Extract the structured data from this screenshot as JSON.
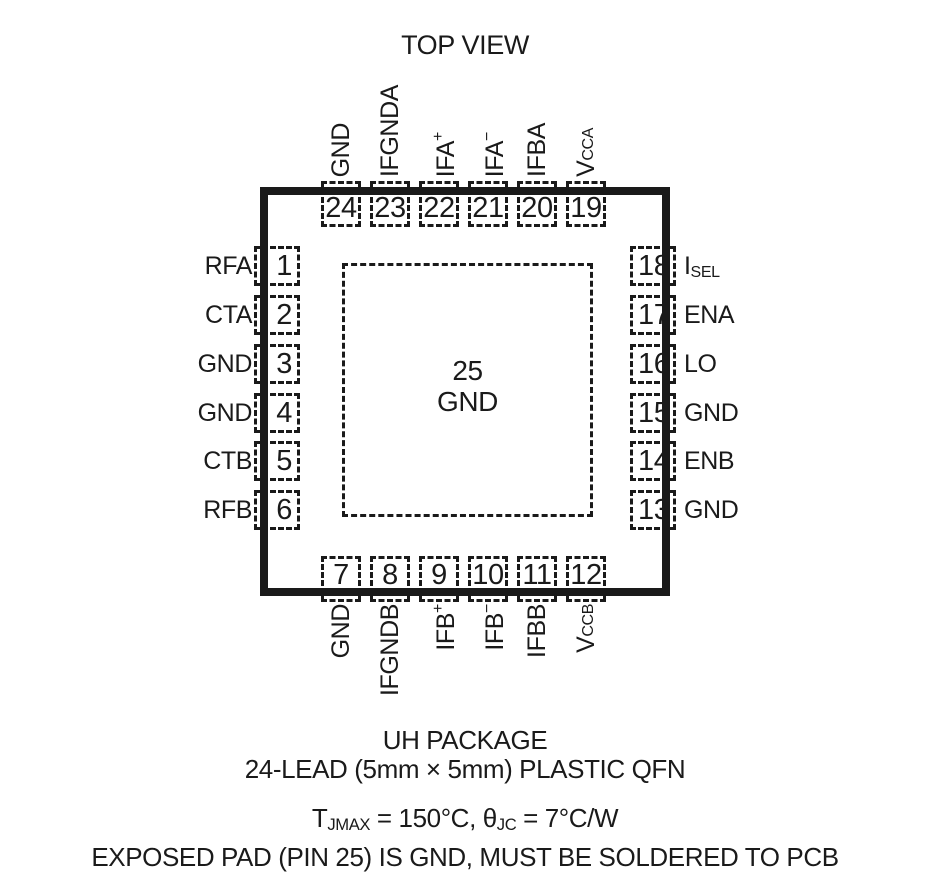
{
  "title": "TOP VIEW",
  "center_pad": {
    "number": "25",
    "label": "GND"
  },
  "pins": {
    "top": [
      {
        "number": "24",
        "label": {
          "base": "GND"
        }
      },
      {
        "number": "23",
        "label": {
          "base": "IFGNDA"
        }
      },
      {
        "number": "22",
        "label": {
          "base": "IFA",
          "sup": "+"
        }
      },
      {
        "number": "21",
        "label": {
          "base": "IFA",
          "sup": "−"
        }
      },
      {
        "number": "20",
        "label": {
          "base": "IFBA"
        }
      },
      {
        "number": "19",
        "label": {
          "base": "V",
          "sub": "CCA"
        }
      }
    ],
    "bottom": [
      {
        "number": "7",
        "label": {
          "base": "GND"
        }
      },
      {
        "number": "8",
        "label": {
          "base": "IFGNDB"
        }
      },
      {
        "number": "9",
        "label": {
          "base": "IFB",
          "sup": "+"
        }
      },
      {
        "number": "10",
        "label": {
          "base": "IFB",
          "sup": "−"
        }
      },
      {
        "number": "11",
        "label": {
          "base": "IFBB"
        }
      },
      {
        "number": "12",
        "label": {
          "base": "V",
          "sub": "CCB"
        }
      }
    ],
    "left": [
      {
        "number": "1",
        "label": {
          "base": "RFA"
        }
      },
      {
        "number": "2",
        "label": {
          "base": "CTA"
        }
      },
      {
        "number": "3",
        "label": {
          "base": "GND"
        }
      },
      {
        "number": "4",
        "label": {
          "base": "GND"
        }
      },
      {
        "number": "5",
        "label": {
          "base": "CTB"
        }
      },
      {
        "number": "6",
        "label": {
          "base": "RFB"
        }
      }
    ],
    "right": [
      {
        "number": "18",
        "label": {
          "base": "I",
          "sub": "SEL"
        }
      },
      {
        "number": "17",
        "label": {
          "base": "ENA"
        }
      },
      {
        "number": "16",
        "label": {
          "base": "LO"
        }
      },
      {
        "number": "15",
        "label": {
          "base": "GND"
        }
      },
      {
        "number": "14",
        "label": {
          "base": "ENB"
        }
      },
      {
        "number": "13",
        "label": {
          "base": "GND"
        }
      }
    ]
  },
  "package_info": {
    "name": "UH PACKAGE",
    "description": "24-LEAD (5mm × 5mm) PLASTIC QFN",
    "thermal": [
      {
        "t": "T"
      },
      {
        "sub": "JMAX"
      },
      {
        "t": " = 150°C, θ"
      },
      {
        "sub": "JC"
      },
      {
        "t": " = 7°C/W"
      }
    ],
    "note": "EXPOSED PAD (PIN 25) IS GND, MUST BE SOLDERED TO PCB"
  },
  "colors": {
    "ink": "#1a1a1a",
    "background": "#ffffff"
  }
}
